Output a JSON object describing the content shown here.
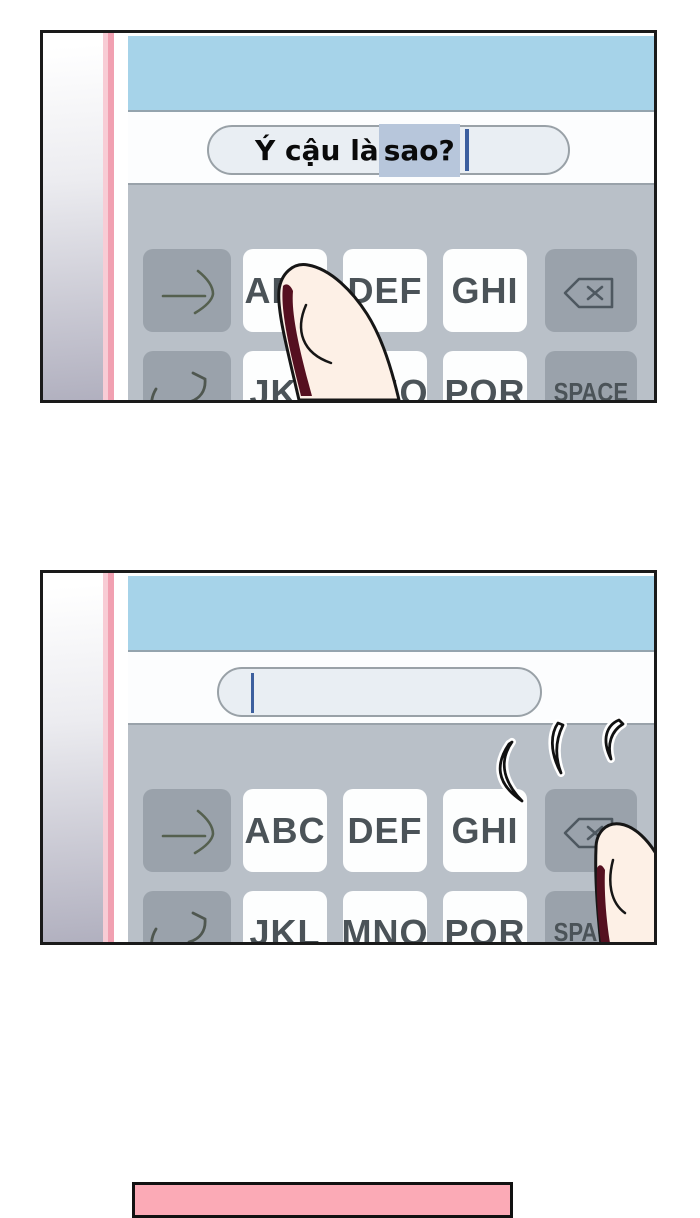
{
  "panel1": {
    "input": {
      "before": "Ý cậu là ",
      "selected": "sao?"
    }
  },
  "panel2": {
    "input": {
      "before": "",
      "selected": ""
    }
  },
  "keyboard": {
    "row1": [
      "",
      "ABC",
      "DEF",
      "GHI",
      ""
    ],
    "row2": [
      "",
      "JKL",
      "MNO",
      "PQR",
      "SPACE"
    ]
  },
  "icons": {
    "row1_left": "send-arrow-icon",
    "row1_right": "backspace-icon",
    "row2_left": "undo-icon"
  },
  "colors": {
    "screen_header": "#a6d3e9",
    "keyboard_bg": "#b9c0c8",
    "key_dark": "#9aa2ab",
    "key_light": "#fdfefe",
    "selection": "#b7c6db",
    "cursor": "#3c5f9e",
    "case_pink": "#f1a0b1",
    "speech_box_pink": "#fbaab6"
  }
}
